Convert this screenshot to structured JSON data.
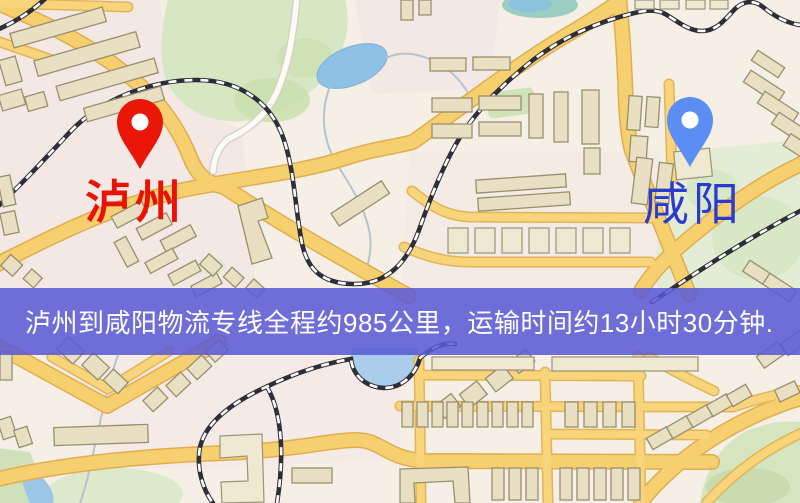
{
  "route": {
    "origin": {
      "label": "泸州"
    },
    "destination": {
      "label": "咸阳"
    },
    "banner_text": "泸州到咸阳物流专线全程约985公里，运输时间约13小时30分钟.",
    "distance_text": "985公里",
    "duration_text": "13小时30分钟"
  },
  "colors": {
    "origin_pin": "#ea1708",
    "origin_label": "#e81208",
    "destination_pin": "#5b8ef3",
    "destination_label": "#2b3bcf",
    "banner_background": "#5858d6",
    "banner_text": "#ffffff",
    "road_yellow": "#f6cf6f",
    "water_blue": "#8fc1e6",
    "park_green": "#d7e6c3",
    "building_tan": "#e9e0c4",
    "railway_dark": "#2e2e38"
  }
}
